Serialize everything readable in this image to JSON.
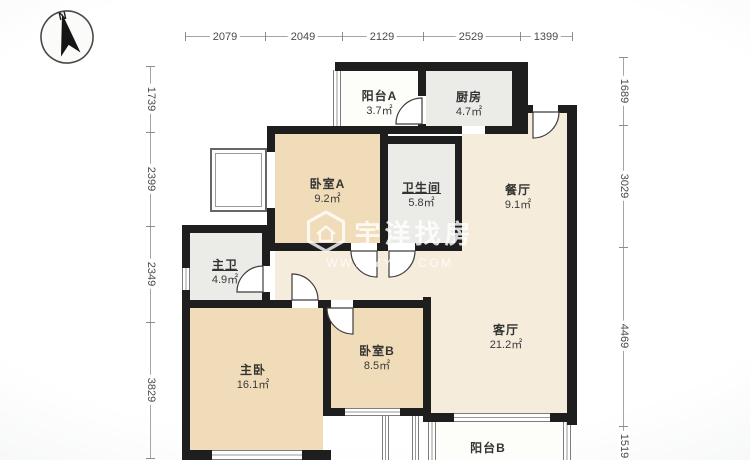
{
  "compass": {
    "label": "N"
  },
  "dimensions": {
    "unit": "mm",
    "top": [
      "2079",
      "2049",
      "2129",
      "2529",
      "1399"
    ],
    "left": [
      "1739",
      "2399",
      "2349",
      "3829"
    ],
    "right": [
      "1689",
      "3029",
      "4469",
      "1519"
    ]
  },
  "rooms": [
    {
      "id": "balcony-a",
      "name": "阳台A",
      "area": "3.7㎡"
    },
    {
      "id": "kitchen",
      "name": "厨房",
      "area": "4.7㎡"
    },
    {
      "id": "bedroom-a",
      "name": "卧室A",
      "area": "9.2㎡"
    },
    {
      "id": "bathroom",
      "name": "卫生间",
      "area": "5.8㎡"
    },
    {
      "id": "dining-room",
      "name": "餐厅",
      "area": "9.1㎡"
    },
    {
      "id": "master-bath",
      "name": "主卫",
      "area": "4.9㎡"
    },
    {
      "id": "master-bedroom",
      "name": "主卧",
      "area": "16.1㎡"
    },
    {
      "id": "bedroom-b",
      "name": "卧室B",
      "area": "8.5㎡"
    },
    {
      "id": "living-room",
      "name": "客厅",
      "area": "21.2㎡"
    },
    {
      "id": "balcony-b",
      "name": "阳台B",
      "area": ""
    }
  ],
  "watermark": {
    "brand": "宇洋找房",
    "url": "WWW.YYZF.COM"
  },
  "colors": {
    "wall": "#1e1e1e",
    "bedroom_fill": "#f0dcb8",
    "living_fill": "#f5ecdb",
    "service_fill": "#ebebe8",
    "balcony_fill": "#fdfdf9"
  }
}
